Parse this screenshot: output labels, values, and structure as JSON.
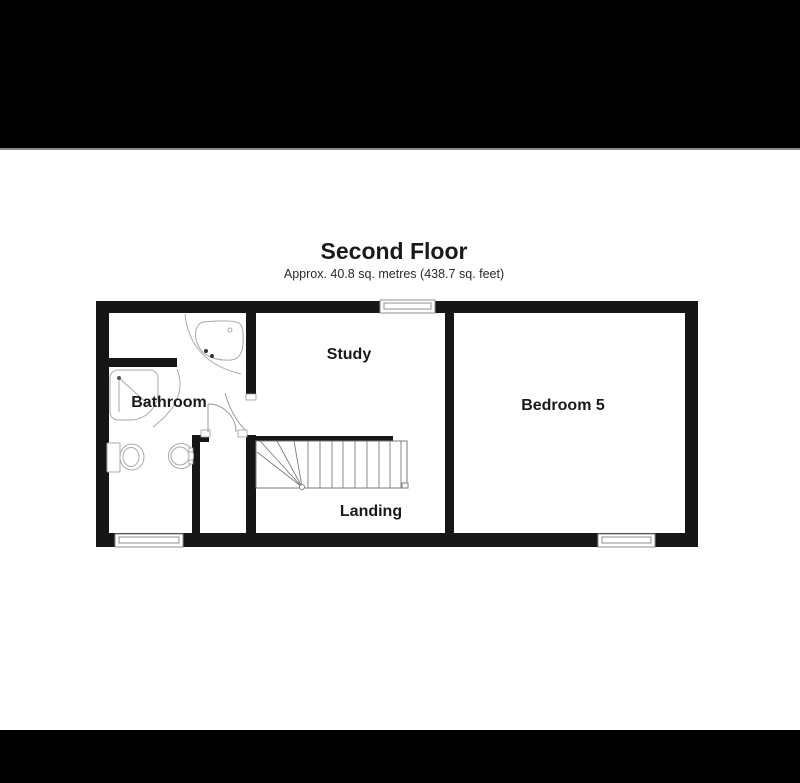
{
  "figure": {
    "title": "Second Floor",
    "subtitle": "Approx. 40.8 sq. metres (438.7 sq. feet)"
  },
  "rooms": {
    "bathroom": {
      "label": "Bathroom"
    },
    "study": {
      "label": "Study"
    },
    "landing": {
      "label": "Landing"
    },
    "bedroom5": {
      "label": "Bedroom 5"
    }
  },
  "fixtures": [
    "corner-bath",
    "quadrant-shower",
    "toilet",
    "sink",
    "staircase"
  ],
  "windows_count": 3,
  "colors": {
    "letterbox": "#000000",
    "wall": "#161616",
    "fixture_line": "#a9a9a9",
    "text": "#1a1a1a",
    "background": "#ffffff"
  }
}
